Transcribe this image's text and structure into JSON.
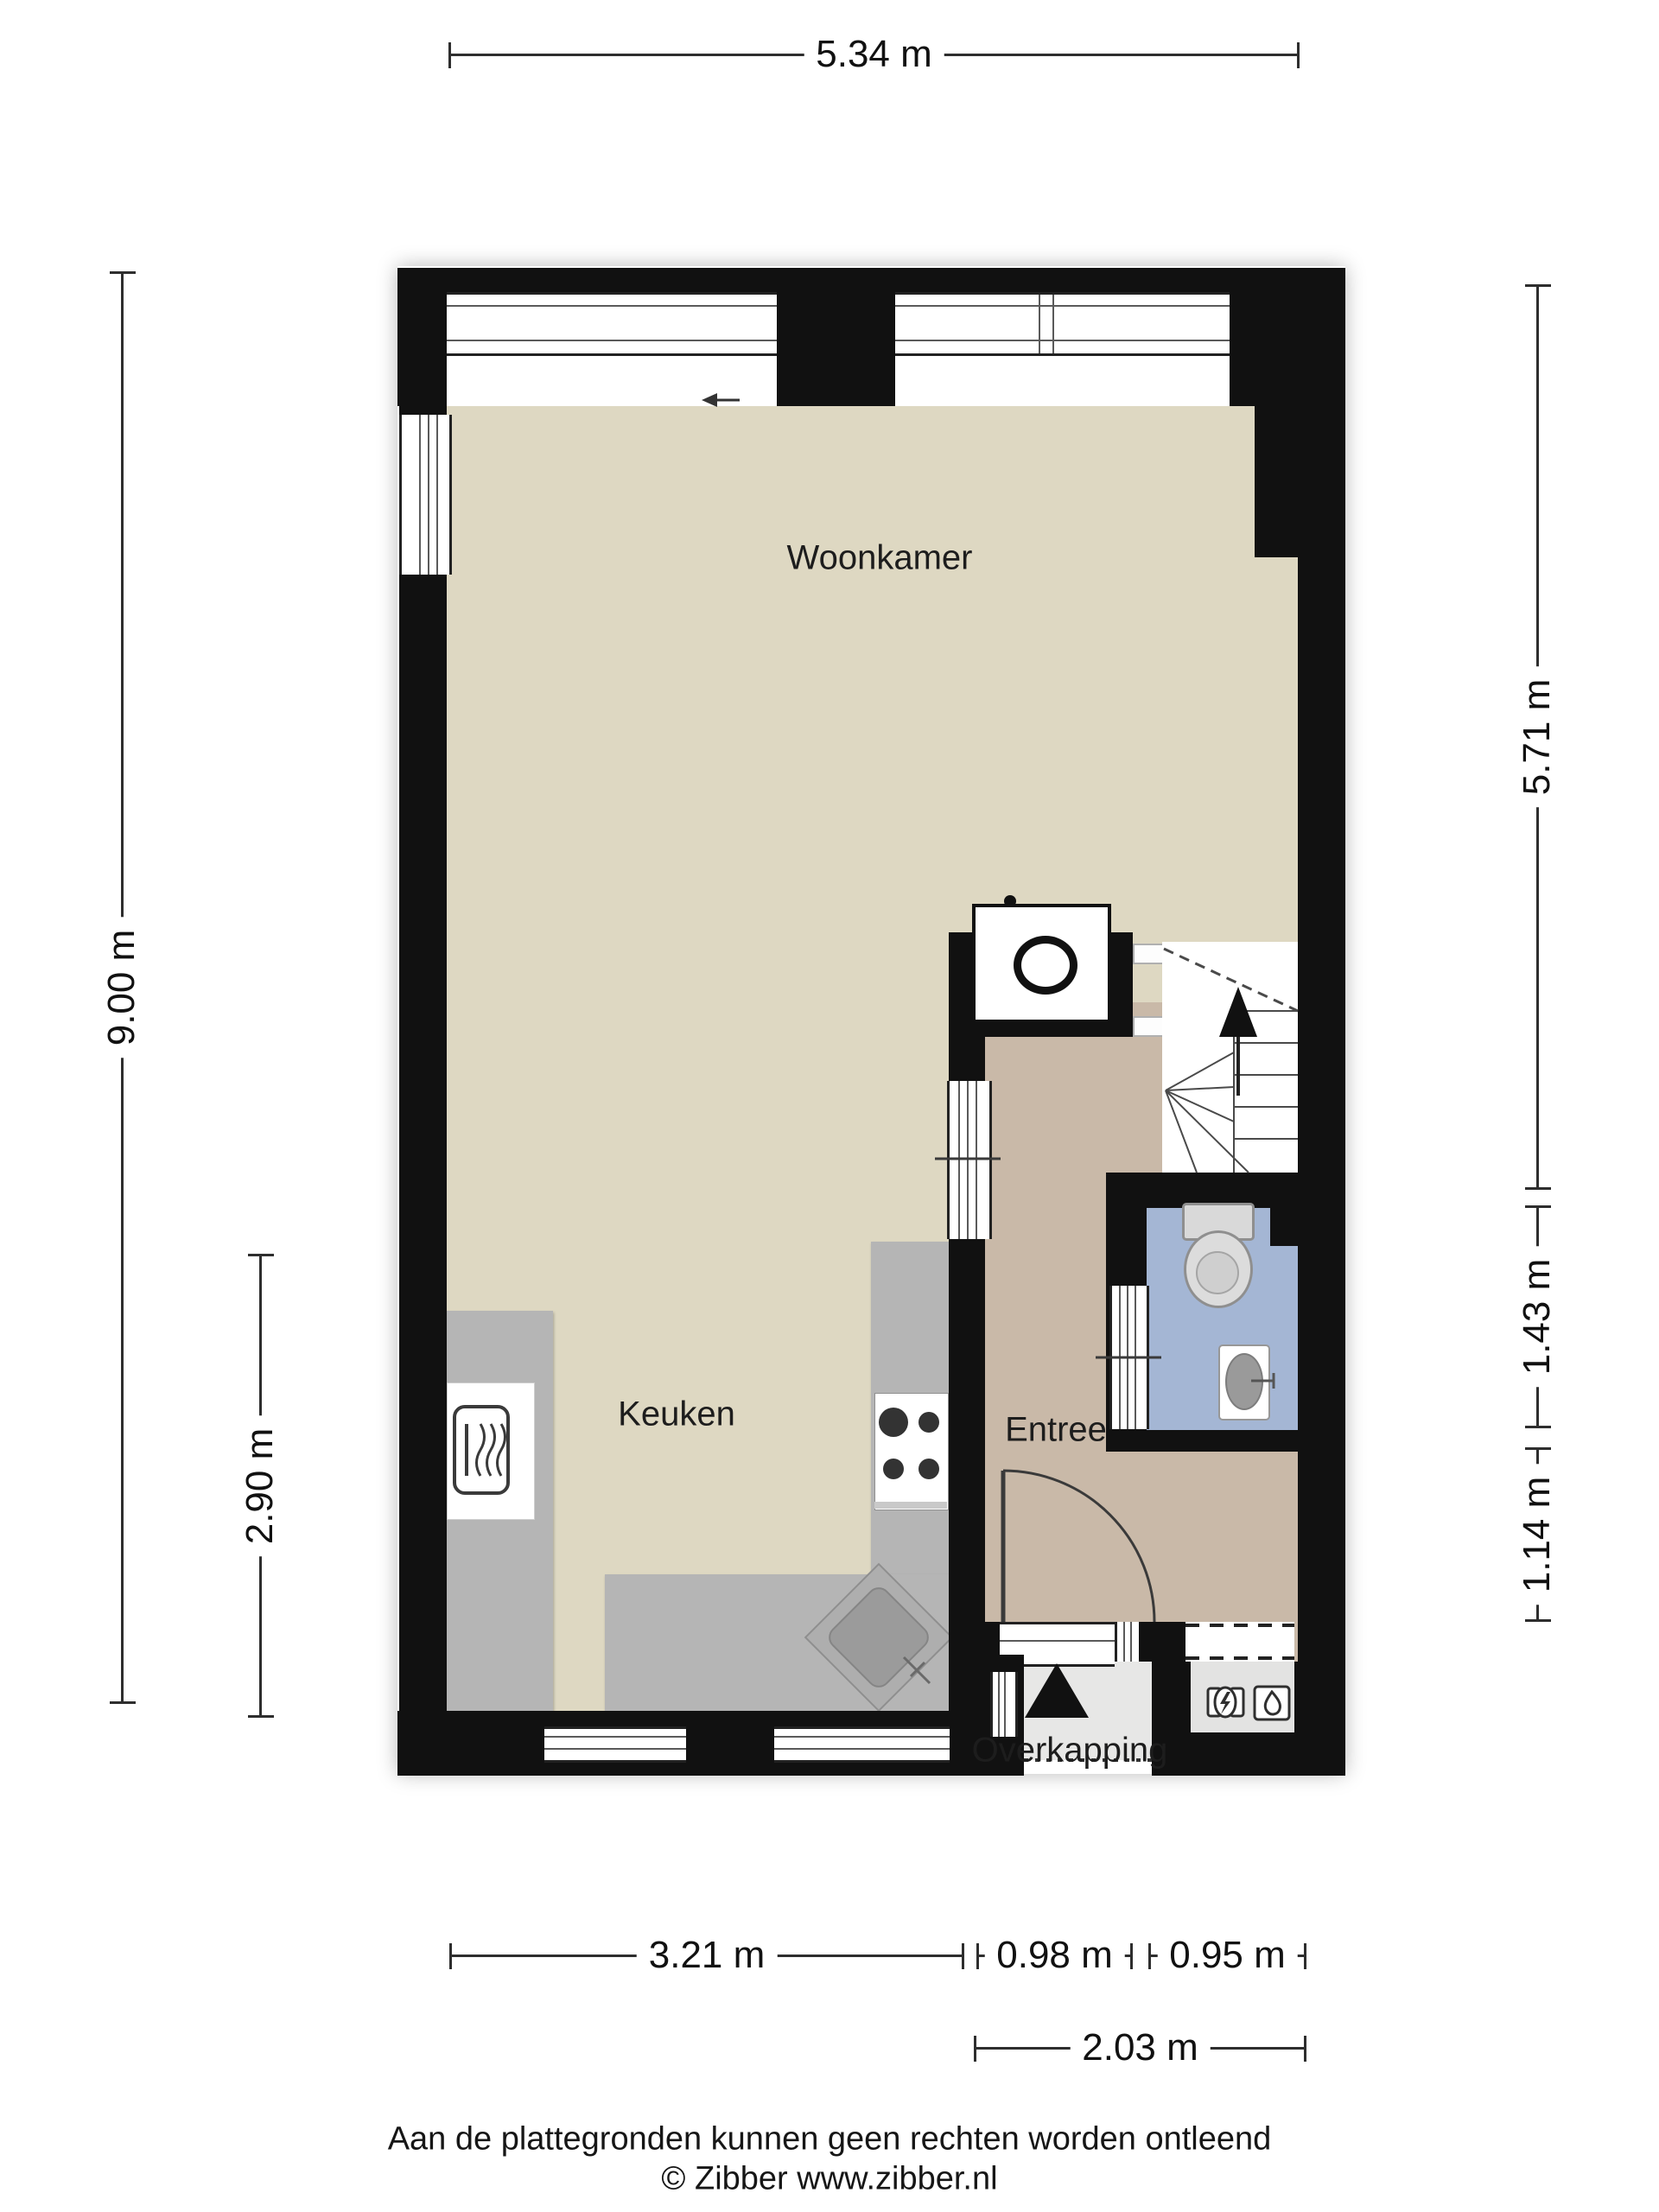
{
  "plan": {
    "type": "floorplan-ground-floor",
    "source_note": "Zibber floor plan"
  },
  "rooms": {
    "woonkamer": "Woonkamer",
    "keuken": "Keuken",
    "entree": "Entree",
    "overkapping": "Overkapping"
  },
  "dimensions": {
    "top_width": "5.34 m",
    "left_total": "9.00 m",
    "left_kitchen": "2.90 m",
    "right_living": "5.71 m",
    "right_toilet": "1.43 m",
    "right_entree": "1.14 m",
    "bottom_kitchen": "3.21 m",
    "bottom_entree": "0.98 m",
    "bottom_meter": "0.95 m",
    "bottom_overkapping": "2.03 m"
  },
  "footer": {
    "disclaimer": "Aan de plattegronden kunnen geen rechten worden ontleend",
    "credit": "© Zibber www.zibber.nl"
  },
  "colors": {
    "wall": "#111111",
    "living_floor": "#ded8c2",
    "entree_floor": "#c9b9a8",
    "toilet_floor": "#a4b6d4",
    "counter": "#b5b5b5",
    "overkapping_floor": "#e7e7e6",
    "dimension_line": "#2e2e2e"
  }
}
